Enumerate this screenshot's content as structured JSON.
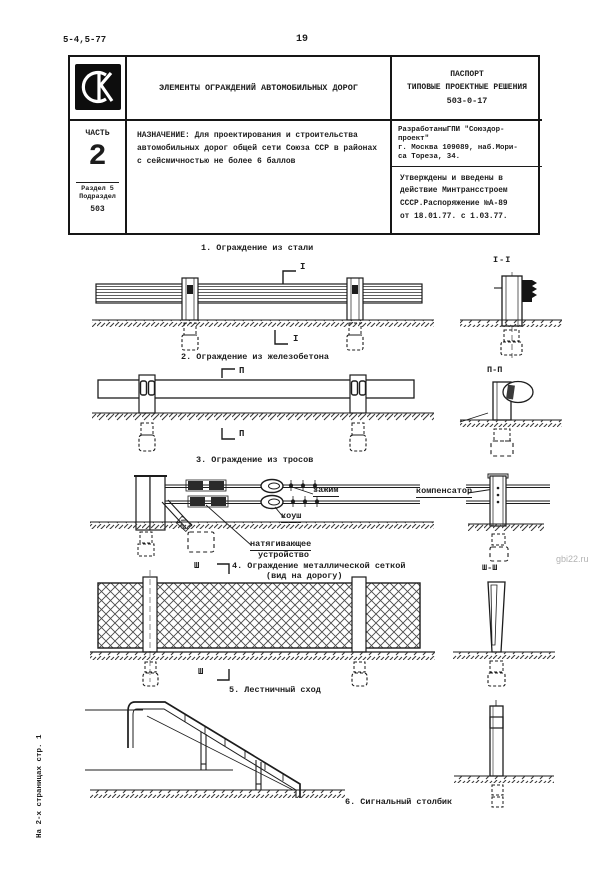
{
  "page": {
    "doc_code": "5-4,5-77",
    "page_number": "19",
    "side_note": "На 2-х страницах стр. 1",
    "watermark": "gbi22.ru",
    "ink_color": "#1c1c1c",
    "paper_color": "#ffffff"
  },
  "title_block": {
    "logo_name": "СК",
    "title": "ЭЛЕМЕНТЫ ОГРАЖДЕНИЙ АВТОМОБИЛЬНЫХ ДОРОГ",
    "doc_type_line1": "ПАСПОРТ",
    "doc_type_line2": "ТИПОВЫЕ ПРОЕКТНЫЕ РЕШЕНИЯ",
    "doc_number": "503-0-17",
    "part_label": "ЧАСТЬ",
    "part_number": "2",
    "razdel": "Раздел 5",
    "podrazdel": "Подраздел",
    "podrazdel_number": "503",
    "purpose": "НАЗНАЧЕНИЕ: Для проектирования и строительства\nавтомобильных дорог общей сети Союза ССР в районах\nс сейсмичностью не более 6 баллов",
    "developer": "РазработаныГПИ \"Союздор-\nпроект\"\nг. Москва 109089, наб.Мори-\nса Тореза, 34.",
    "approval": "Утверждены и  введены в\nдействие Минтрансстроем\nСССР.Распоряжение №А-89\nот 18.01.77. с 1.03.77."
  },
  "figures": {
    "fig1": {
      "caption": "1. Ограждение из стали",
      "section_mark": "I",
      "section_view": "I-I"
    },
    "fig2": {
      "caption": "2. Ограждение из железобетона",
      "section_mark": "П",
      "section_view": "П-П"
    },
    "fig3": {
      "caption": "3. Ограждение из тросов",
      "label_clamp": "зажим",
      "label_thimble": "коуш",
      "label_tensioner_line1": "натягивающее",
      "label_tensioner_line2": "устройство",
      "label_compensator": "компенсатор"
    },
    "fig4": {
      "caption_line1": "4. Ограждение металлической сеткой",
      "caption_line2": "(вид на дорогу)",
      "section_mark": "Ш",
      "section_view": "Ш-Ш"
    },
    "fig5": {
      "caption": "5. Лестничный сход"
    },
    "fig6": {
      "caption": "6. Сигнальный столбик"
    }
  }
}
